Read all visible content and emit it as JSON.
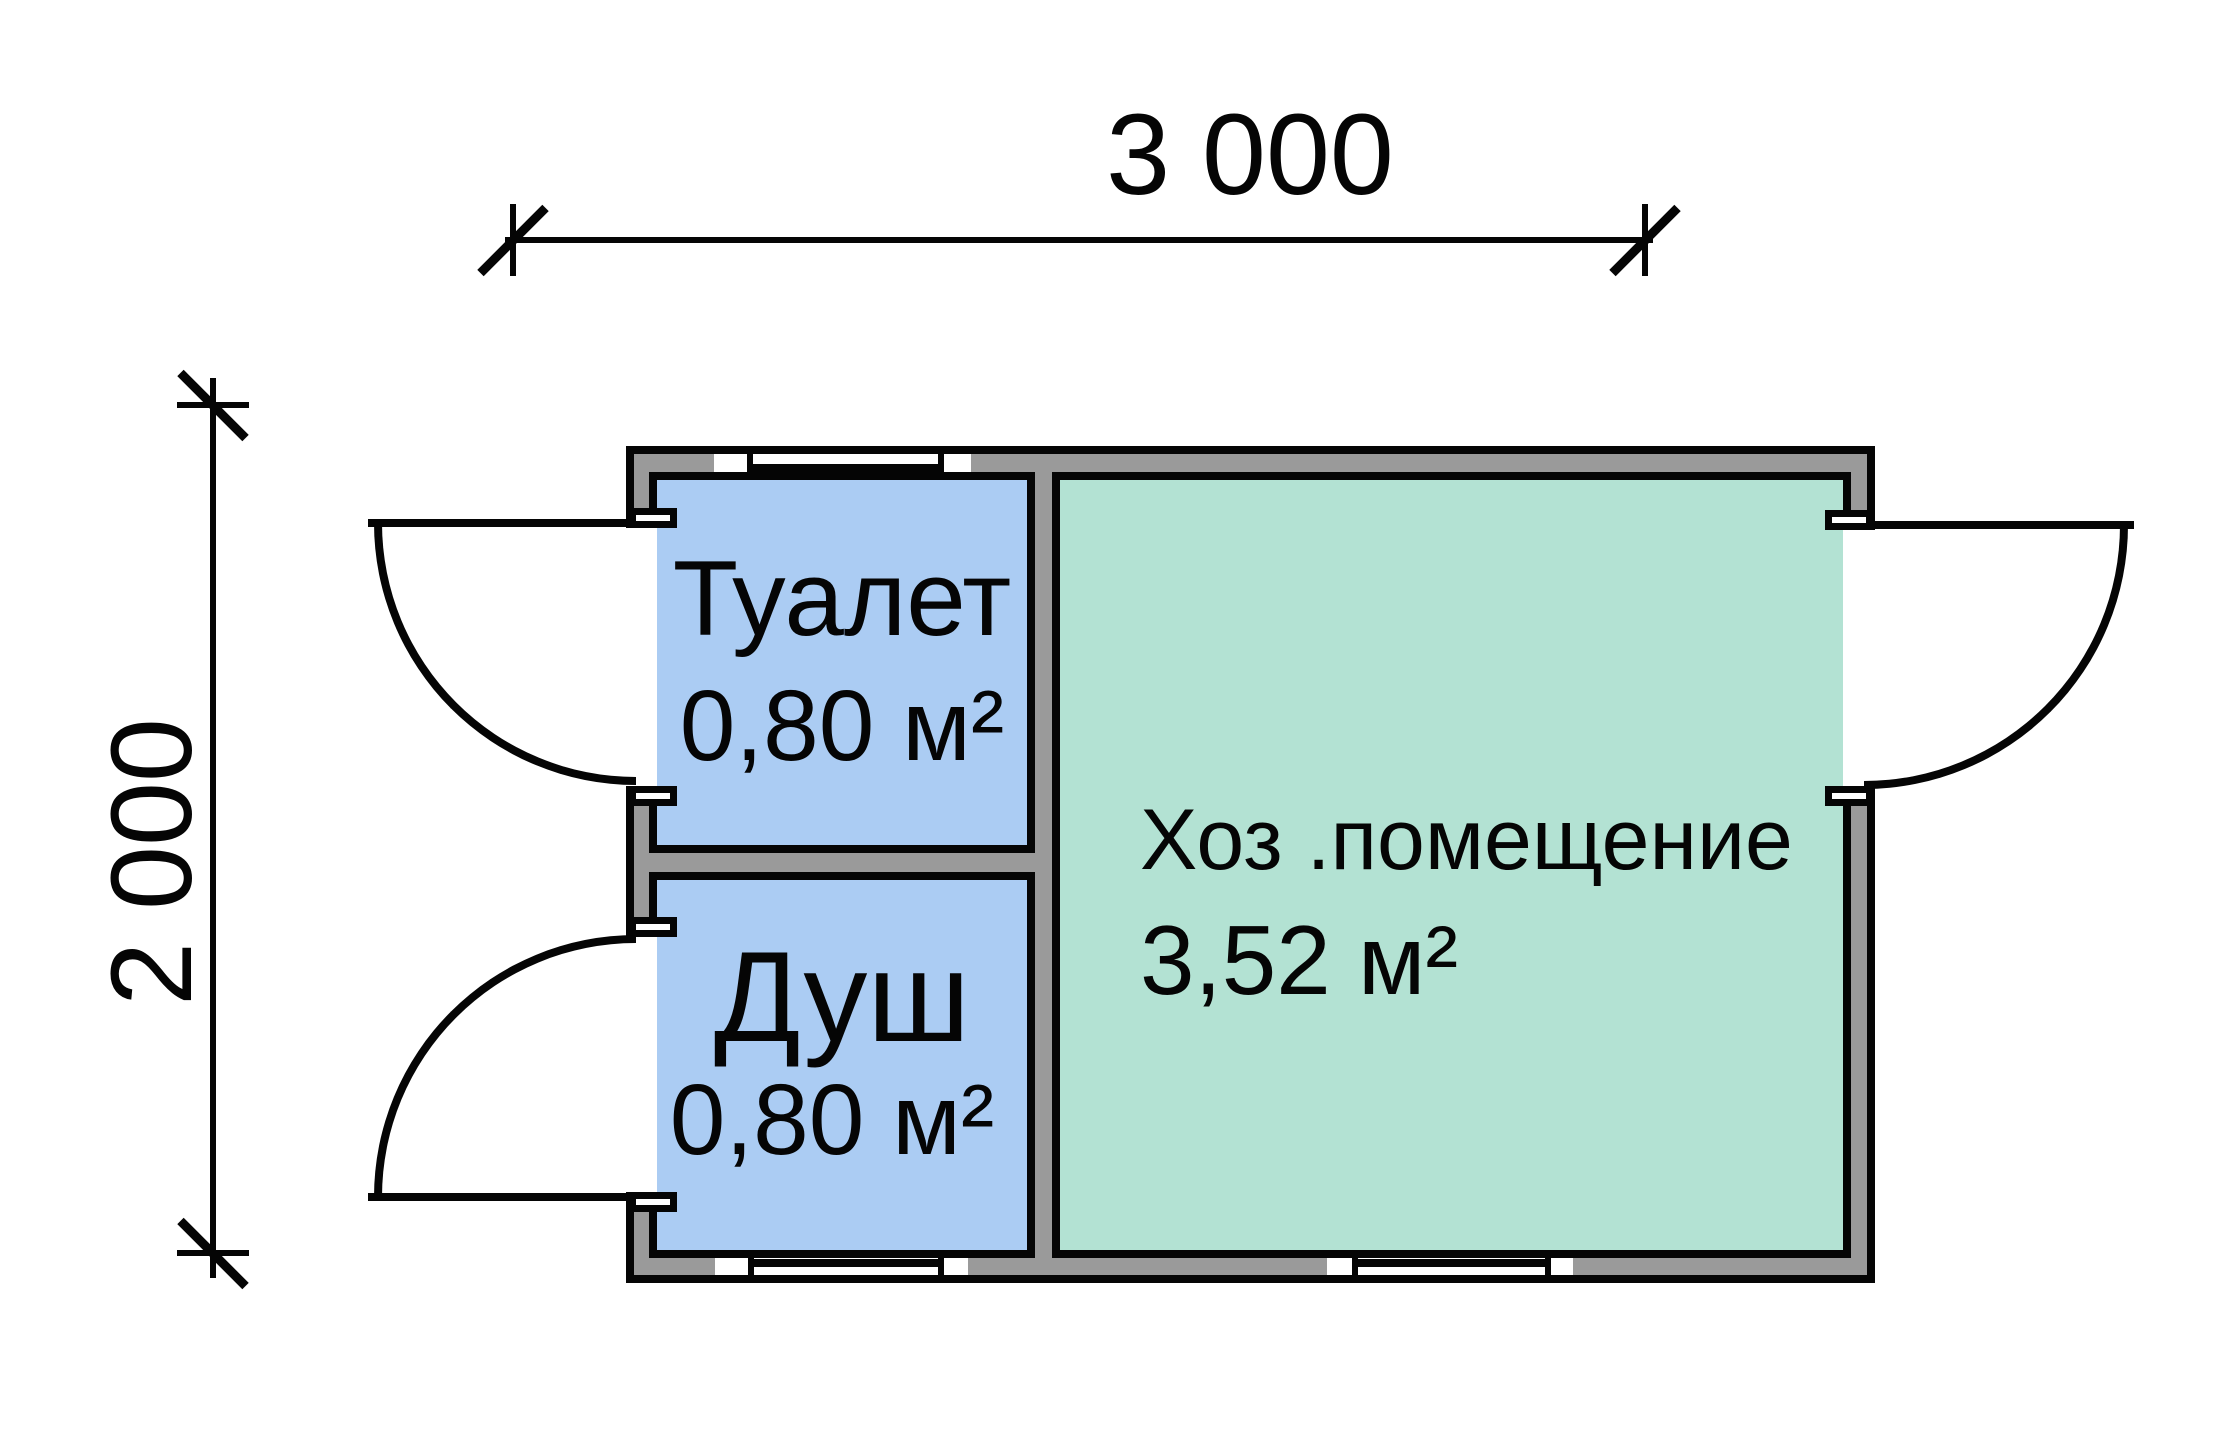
{
  "plan": {
    "dim_width": "3 000",
    "dim_height": "2 000",
    "rooms": {
      "toilet": {
        "name": "Туалет",
        "area": "0,80 м²"
      },
      "shower": {
        "name": "Душ",
        "area": "0,80 м²"
      },
      "utility": {
        "name": "Хоз .помещение",
        "area": "3,52 м²"
      }
    },
    "colors": {
      "wall_gray": "#9a9a9a",
      "room_blue": "#abccf3",
      "room_green": "#b3e2d3",
      "line_black": "#050505",
      "background": "#ffffff"
    }
  }
}
